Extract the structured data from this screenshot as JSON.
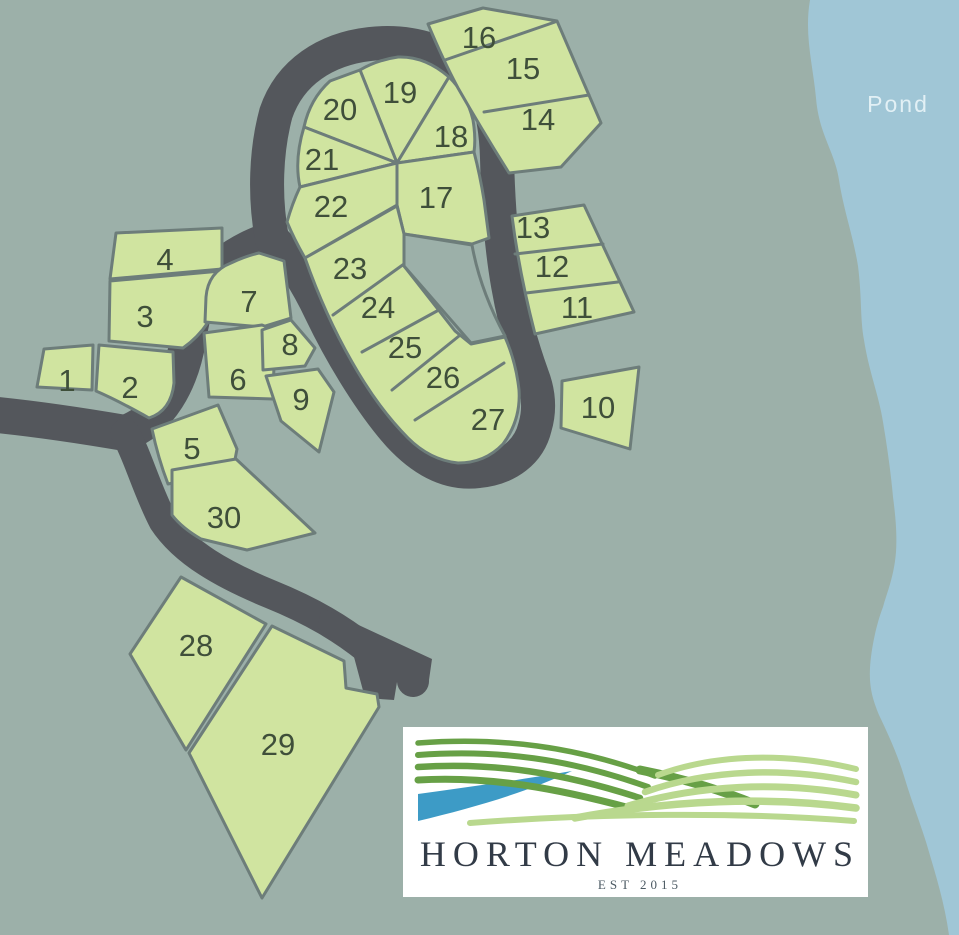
{
  "map": {
    "pond_label": "Pond",
    "lots": [
      "1",
      "2",
      "3",
      "4",
      "5",
      "6",
      "7",
      "8",
      "9",
      "10",
      "11",
      "12",
      "13",
      "14",
      "15",
      "16",
      "17",
      "18",
      "19",
      "20",
      "21",
      "22",
      "23",
      "24",
      "25",
      "26",
      "27",
      "28",
      "29",
      "30"
    ]
  },
  "logo": {
    "title": "HORTON MEADOWS",
    "established": "EST 2015"
  },
  "colors": {
    "background": "#9cb0a9",
    "road": "#54575c",
    "lot_fill": "#d0e4a0",
    "lot_border": "#6d7d7a",
    "lot_number": "#3f4f3a",
    "pond": "#a0c6d6",
    "pond_text": "#e2f0f5",
    "logo_bg": "#ffffff",
    "logo_dark_green": "#67a046",
    "logo_light_green": "#b9d88e",
    "logo_blue": "#3d9bc6",
    "logo_text": "#323b47",
    "logo_est_text": "#4c5a63"
  }
}
